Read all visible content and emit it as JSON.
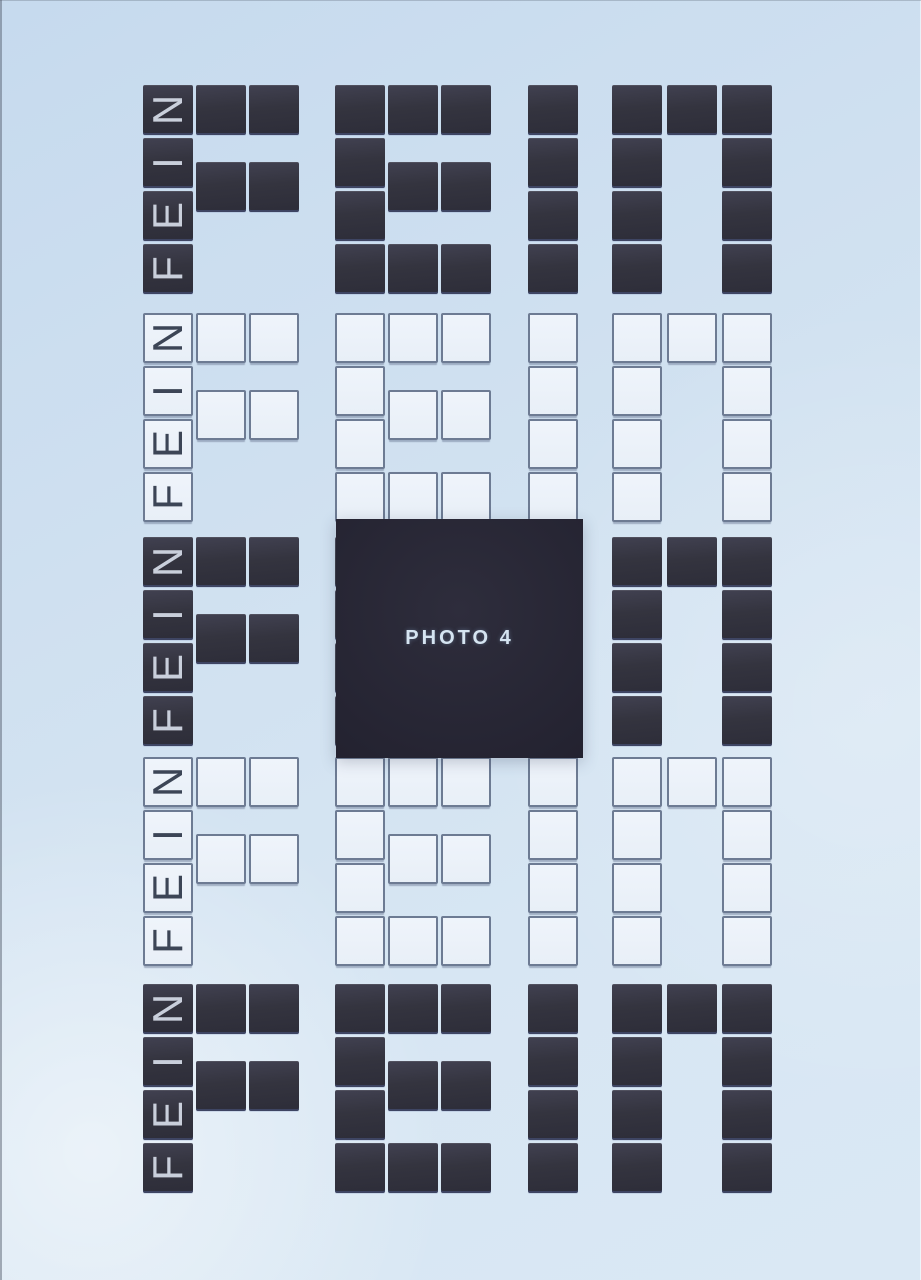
{
  "poster": {
    "word": "FEIN",
    "photo_label": "PHOTO 4",
    "label_letters_top_to_bottom": [
      "N",
      "I",
      "E",
      "F"
    ],
    "colors": {
      "background_top": "#c6daee",
      "background_bottom": "#dae8f4",
      "dark_tile": "#34343f",
      "dark_tile_letter": "#c9cfdb",
      "dark_tile_bottom_glow": "#6e86d8",
      "light_tile_fill": "#e8eff7",
      "light_tile_border": "#6d7b93",
      "light_tile_letter": "#3c4556",
      "photo_bg": "#242331",
      "photo_text": "#d5e4f1"
    },
    "metrics": {
      "tile_size": 50,
      "row_pitch": 53,
      "rows_y": [
        85,
        313,
        537,
        757,
        984
      ],
      "row_themes": [
        "dark",
        "light",
        "dark",
        "light",
        "dark"
      ],
      "letters": [
        {
          "name": "F",
          "x": 143,
          "pitch": 53,
          "labeled": true,
          "tiles": [
            [
              0,
              0
            ],
            [
              1,
              0
            ],
            [
              2,
              0
            ],
            [
              0,
              1
            ],
            [
              1,
              1.45
            ],
            [
              2,
              1.45
            ],
            [
              0,
              2
            ],
            [
              0,
              3
            ]
          ]
        },
        {
          "name": "E",
          "x": 335,
          "pitch": 53,
          "tiles": [
            [
              0,
              0
            ],
            [
              1,
              0
            ],
            [
              2,
              0
            ],
            [
              0,
              1
            ],
            [
              1,
              1.45
            ],
            [
              2,
              1.45
            ],
            [
              0,
              2
            ],
            [
              0,
              3
            ],
            [
              1,
              3
            ],
            [
              2,
              3
            ]
          ]
        },
        {
          "name": "I",
          "x": 528,
          "pitch": 53,
          "tiles": [
            [
              0,
              0
            ],
            [
              0,
              1
            ],
            [
              0,
              2
            ],
            [
              0,
              3
            ]
          ]
        },
        {
          "name": "N",
          "x": 612,
          "pitch": 55,
          "tiles": [
            [
              0,
              0
            ],
            [
              1,
              0
            ],
            [
              2,
              0
            ],
            [
              0,
              1
            ],
            [
              2,
              1
            ],
            [
              0,
              2
            ],
            [
              2,
              2
            ],
            [
              0,
              3
            ],
            [
              2,
              3
            ]
          ]
        }
      ]
    },
    "photo_rect": {
      "x": 336,
      "y": 519,
      "w": 247,
      "h": 239
    }
  }
}
